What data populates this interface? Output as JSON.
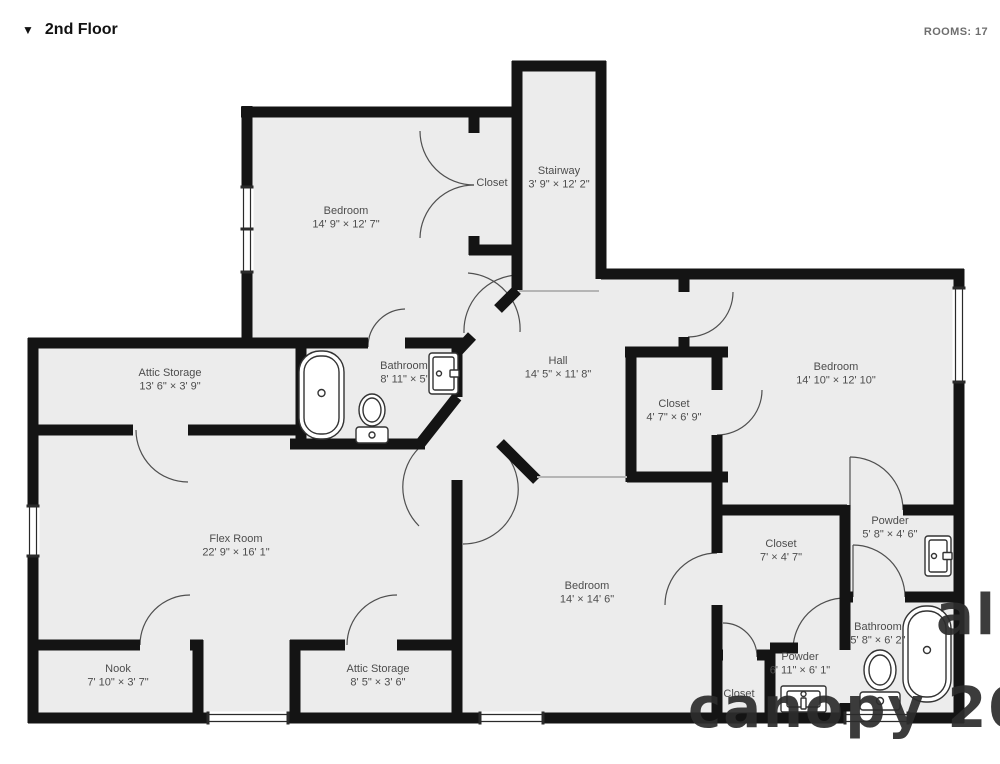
{
  "header": {
    "collapse_icon": "▼",
    "title": "2nd Floor",
    "rooms_counter": "ROOMS: 17"
  },
  "plan": {
    "wall_color": "#141414",
    "floor_color": "#ececec",
    "label_color": "#4d4d4d",
    "rooms": [
      {
        "id": "closet-top",
        "name": "Closet",
        "dims": "",
        "x": 492,
        "y": 186
      },
      {
        "id": "stairway",
        "name": "Stairway",
        "dims": "3' 9\" × 12' 2\"",
        "x": 559,
        "y": 174
      },
      {
        "id": "bedroom-upper-left",
        "name": "Bedroom",
        "dims": "14' 9\" × 12' 7\"",
        "x": 346,
        "y": 214
      },
      {
        "id": "attic-storage-1",
        "name": "Attic Storage",
        "dims": "13' 6\" × 3' 9\"",
        "x": 170,
        "y": 376
      },
      {
        "id": "bathroom-1",
        "name": "Bathroom",
        "dims": "8' 11\" × 5'",
        "x": 404,
        "y": 369
      },
      {
        "id": "hall",
        "name": "Hall",
        "dims": "14' 5\" × 11' 8\"",
        "x": 558,
        "y": 364
      },
      {
        "id": "closet-hall",
        "name": "Closet",
        "dims": "4' 7\" × 6' 9\"",
        "x": 674,
        "y": 407
      },
      {
        "id": "bedroom-right",
        "name": "Bedroom",
        "dims": "14' 10\" × 12' 10\"",
        "x": 836,
        "y": 370
      },
      {
        "id": "flex-room",
        "name": "Flex Room",
        "dims": "22' 9\" × 16' 1\"",
        "x": 236,
        "y": 542
      },
      {
        "id": "powder-1",
        "name": "Powder",
        "dims": "5' 8\" × 4' 6\"",
        "x": 890,
        "y": 524
      },
      {
        "id": "closet-bedroom",
        "name": "Closet",
        "dims": "7' × 4' 7\"",
        "x": 781,
        "y": 547
      },
      {
        "id": "bedroom-bottom",
        "name": "Bedroom",
        "dims": "14' × 14' 6\"",
        "x": 587,
        "y": 589
      },
      {
        "id": "bathroom-2",
        "name": "Bathroom",
        "dims": "5' 8\" × 6' 2\"",
        "x": 878,
        "y": 630
      },
      {
        "id": "powder-2",
        "name": "Powder",
        "dims": "6' 11\" × 6' 1\"",
        "x": 800,
        "y": 660
      },
      {
        "id": "nook",
        "name": "Nook",
        "dims": "7' 10\" × 3' 7\"",
        "x": 118,
        "y": 672
      },
      {
        "id": "attic-storage-2",
        "name": "Attic Storage",
        "dims": "8' 5\" × 3' 6\"",
        "x": 378,
        "y": 672
      },
      {
        "id": "closet-small",
        "name": "Closet",
        "dims": "",
        "x": 739,
        "y": 697
      }
    ],
    "fixtures": [
      "bathtub",
      "toilet",
      "sink",
      "bathtub",
      "toilet",
      "sink",
      "vanity-sink"
    ]
  },
  "watermark": {
    "fragment_bottom": "canopy 202",
    "fragment_right": "al"
  }
}
